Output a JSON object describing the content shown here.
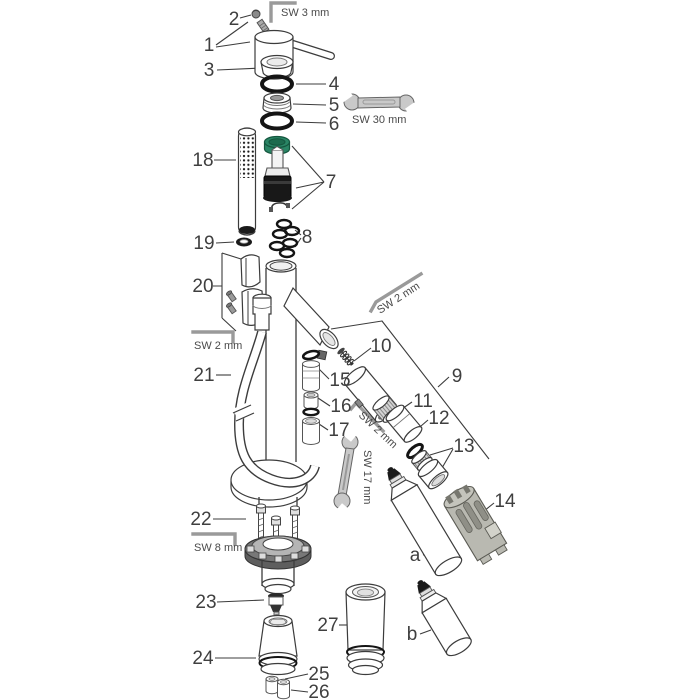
{
  "diagram": {
    "type": "exploded-parts-diagram",
    "subject": "single-lever-mixer-faucet-with-handshower",
    "callouts": {
      "c1": "1",
      "c2": "2",
      "c3": "3",
      "c4": "4",
      "c5": "5",
      "c6": "6",
      "c7": "7",
      "c8": "8",
      "c9": "9",
      "c10": "10",
      "c11": "11",
      "c12": "12",
      "c13": "13",
      "c14": "14",
      "c15": "15",
      "c16": "16",
      "c17": "17",
      "c18": "18",
      "c19": "19",
      "c20": "20",
      "c21": "21",
      "c22": "22",
      "c23": "23",
      "c24": "24",
      "c25": "25",
      "c26": "26",
      "c27": "27",
      "ca": "a",
      "cb": "b"
    },
    "tool_labels": {
      "hex_top": "SW 3 mm",
      "wrench_30": "SW 30 mm",
      "hex_left": "SW 2 mm",
      "hex_spout": "SW 2 mm",
      "hex_aerator": "SW 2 mm",
      "wrench_17": "SW 17 mm",
      "hex_base": "SW 8 mm"
    },
    "colors": {
      "line": "#3c3c3c",
      "cartridge_cap": "#2a8565",
      "cartridge_cap_dark": "#1d6b4e",
      "cartridge_cap_rim": "#14563e",
      "tool_grey": "#b9b9b1",
      "wrench_grey": "#c9c9c9",
      "key_grey": "#9a9a9a",
      "black_part": "#181818"
    }
  }
}
